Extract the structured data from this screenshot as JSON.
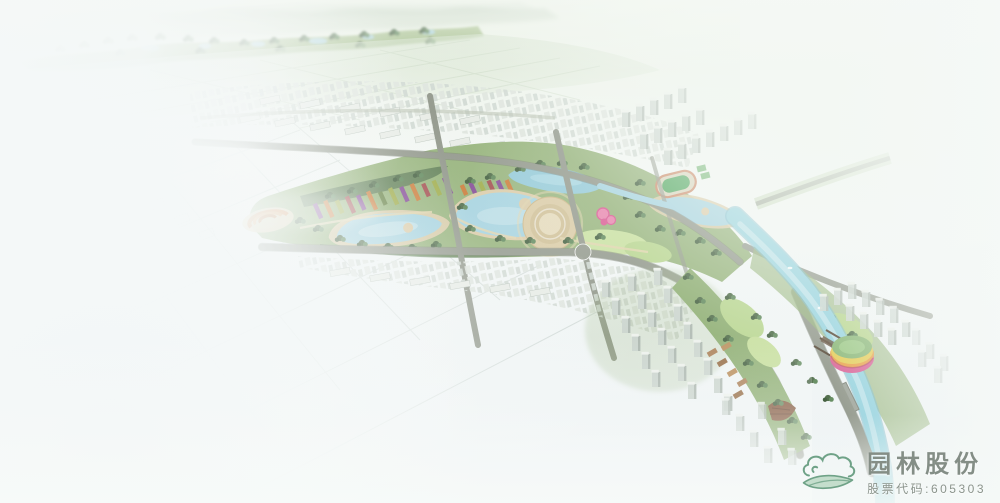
{
  "logo": {
    "company": "园林股份",
    "stock_code": "股票代码:605303"
  },
  "colors": {
    "water": "#9fd0de",
    "water_deep": "#8cc6d6",
    "river": "#8fd0dd",
    "river_edge": "#6fb6c8",
    "sand": "#d9c8a2",
    "path_tan": "#e0d2a8",
    "park": "#8fae72",
    "park_dark": "#7a9c60",
    "lawn": "#b4d388",
    "tree": "#41603a",
    "road": "#8a9083",
    "road_dark": "#6e7468",
    "hill": "#b7c9b3",
    "field": "#cfdec6",
    "building": "#d6ddd6",
    "flower_purple": "#7c3f8f",
    "flower_orange": "#c8722a",
    "flower_olive": "#98a63c",
    "flower_red": "#9c4040",
    "flower_green": "#5c7a38",
    "plaza_orange": "#d8823c",
    "stadium_pink": "#d6568f",
    "stadium_orange": "#e89a3c",
    "stadium_yellow": "#e3c94a",
    "stadium_roof": "#7fb06a",
    "pier_brown": "#5a4632",
    "shell_brown": "#7a4a2e",
    "logo_green": "#6fa287",
    "logo_text": "#848e86",
    "mist": "#f9fbfa"
  }
}
